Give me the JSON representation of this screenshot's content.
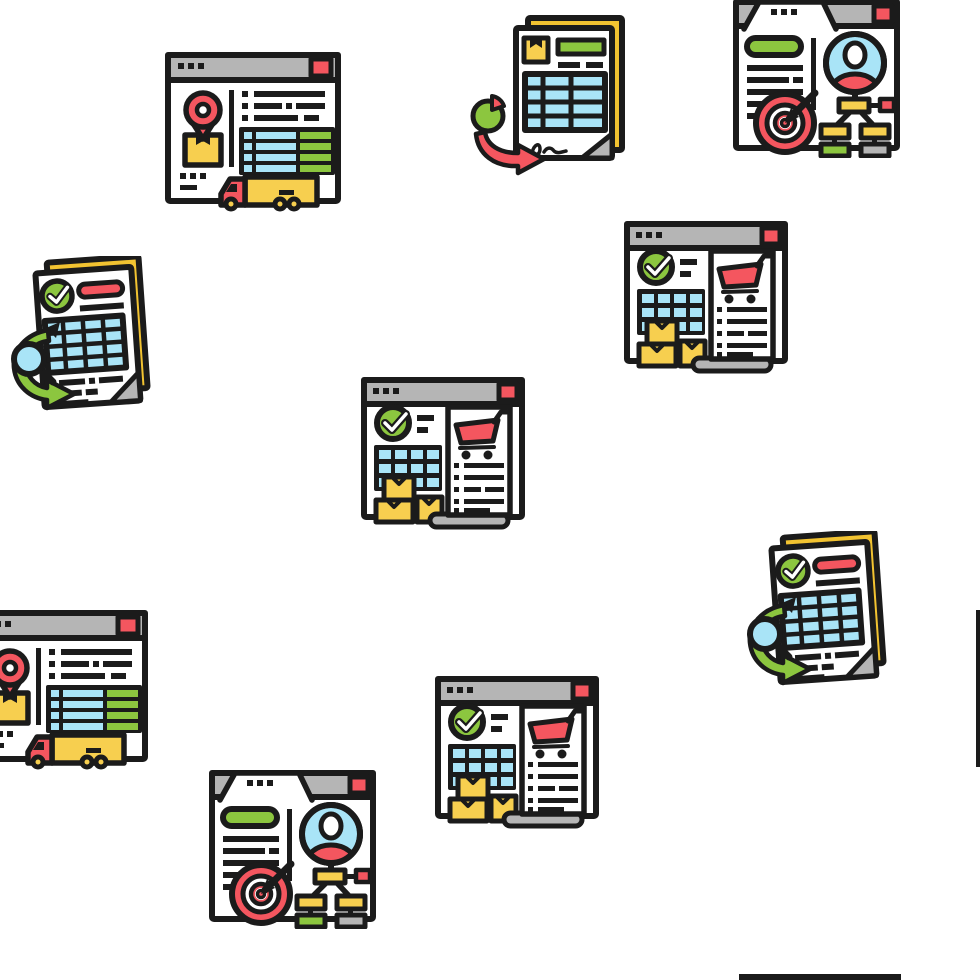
{
  "canvas": {
    "width": 980,
    "height": 980,
    "background": "#ffffff"
  },
  "pattern": {
    "name": "logistics-order-report-seamless-icon-pattern",
    "style": "flat line color icons, thick dark outlines, white background"
  },
  "palette": {
    "outline": "#1b1b1b",
    "window_gray": "#b5b5b5",
    "red": "#f4565f",
    "yellow": "#f7cf4f",
    "paper_yellow": "#f2c331",
    "green": "#8cc63f",
    "light_blue": "#a9e4f7",
    "gray": "#b5b5b5",
    "white": "#ffffff"
  },
  "legend": [
    {
      "type": "delivery-tracking-window",
      "meaning": "web window with location-pin over parcel, shipment table and cargo truck"
    },
    {
      "type": "invoice-report-document",
      "meaning": "invoice sheets with parcel mark, grid table, signature, pie-chart and red curved arrow"
    },
    {
      "type": "customer-profile-window",
      "meaning": "web window with user avatar, organization flow-chart and dart target"
    },
    {
      "type": "purchase-order-window",
      "meaning": "web window with check mark, calendar grid, parcels and shopping-cart receipt"
    },
    {
      "type": "verified-report-document",
      "meaning": "checked report sheets with table, magnifier and green curved arrow"
    }
  ],
  "icons": [
    {
      "id": "delivery-tracking-window-top-left",
      "type": "delivery-tracking-window",
      "x": 163,
      "y": 49,
      "width": 182,
      "height": 166
    },
    {
      "id": "invoice-report-document-top-center",
      "type": "invoice-report-document",
      "x": 466,
      "y": 10,
      "width": 168,
      "height": 166
    },
    {
      "id": "customer-profile-window-top-right",
      "type": "customer-profile-window",
      "x": 731,
      "y": -4,
      "width": 171,
      "height": 162
    },
    {
      "id": "verified-report-document-left",
      "type": "verified-report-document",
      "x": 2,
      "y": 256,
      "width": 163,
      "height": 163
    },
    {
      "id": "purchase-order-window-right",
      "type": "purchase-order-window",
      "x": 623,
      "y": 219,
      "width": 167,
      "height": 163
    },
    {
      "id": "purchase-order-window-center",
      "type": "purchase-order-window",
      "x": 360,
      "y": 375,
      "width": 167,
      "height": 163
    },
    {
      "id": "delivery-tracking-window-bottom-left",
      "type": "delivery-tracking-window",
      "x": -30,
      "y": 607,
      "width": 182,
      "height": 166
    },
    {
      "id": "customer-profile-window-bottom",
      "type": "customer-profile-window",
      "x": 207,
      "y": 767,
      "width": 171,
      "height": 162
    },
    {
      "id": "purchase-order-window-bottom",
      "type": "purchase-order-window",
      "x": 434,
      "y": 674,
      "width": 167,
      "height": 163
    },
    {
      "id": "verified-report-document-right",
      "type": "verified-report-document",
      "x": 738,
      "y": 531,
      "width": 163,
      "height": 163
    }
  ],
  "edge_fragments": [
    {
      "id": "wrapped-window-left-border-right-edge",
      "x": 976,
      "y": 610,
      "width": 4,
      "height": 157
    },
    {
      "id": "wrapped-window-top-border-bottom-edge",
      "x": 739,
      "y": 974,
      "width": 162,
      "height": 6
    }
  ]
}
